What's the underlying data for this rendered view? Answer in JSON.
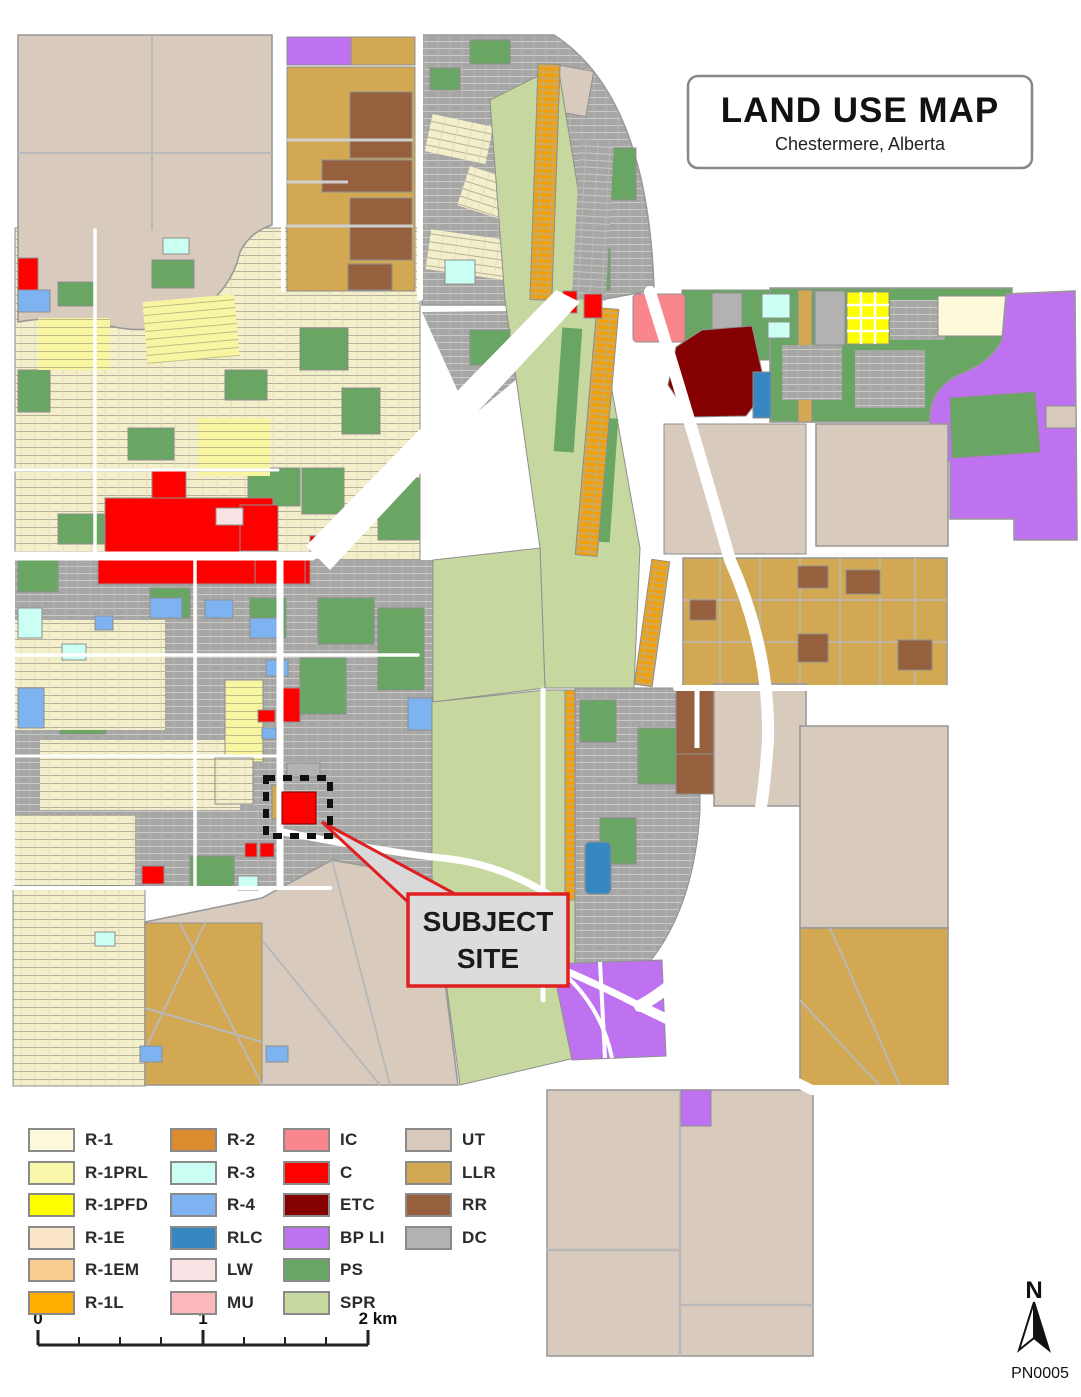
{
  "title": {
    "main": "LAND USE MAP",
    "subtitle": "Chestermere, Alberta"
  },
  "callout": {
    "line1": "SUBJECT",
    "line2": "SITE"
  },
  "scalebar": {
    "start": "0",
    "middle": "1",
    "end": "2 km"
  },
  "north_label": "N",
  "plan_number": "PN0005",
  "legend": {
    "columns": [
      {
        "items": [
          {
            "code": "R-1",
            "color": "#FCFADB"
          },
          {
            "code": "R-1PRL",
            "color": "#F9F7A9"
          },
          {
            "code": "R-1PFD",
            "color": "#FFFF00"
          },
          {
            "code": "R-1E",
            "color": "#FAE5C7"
          },
          {
            "code": "R-1EM",
            "color": "#F9CD90"
          },
          {
            "code": "R-1L",
            "color": "#FFAE00"
          }
        ]
      },
      {
        "items": [
          {
            "code": "R-2",
            "color": "#DD8C2D"
          },
          {
            "code": "R-3",
            "color": "#CBFFF3"
          },
          {
            "code": "R-4",
            "color": "#7EB3F1"
          },
          {
            "code": "RLC",
            "color": "#3787C0"
          },
          {
            "code": "LW",
            "color": "#FBE3E5"
          },
          {
            "code": "MU",
            "color": "#FAB8BC"
          }
        ]
      },
      {
        "items": [
          {
            "code": "IC",
            "color": "#F8868C"
          },
          {
            "code": "C",
            "color": "#FE0000"
          },
          {
            "code": "ETC",
            "color": "#850000"
          },
          {
            "code": "BP LI",
            "color": "#BE72F0"
          },
          {
            "code": "PS",
            "color": "#69A563"
          },
          {
            "code": "SPR",
            "color": "#C6D8A0"
          }
        ]
      },
      {
        "items": [
          {
            "code": "UT",
            "color": "#D8CBBD"
          },
          {
            "code": "LLR",
            "color": "#D2A952"
          },
          {
            "code": "RR",
            "color": "#96603F"
          },
          {
            "code": "DC",
            "color": "#B2B2B2"
          }
        ]
      }
    ]
  }
}
